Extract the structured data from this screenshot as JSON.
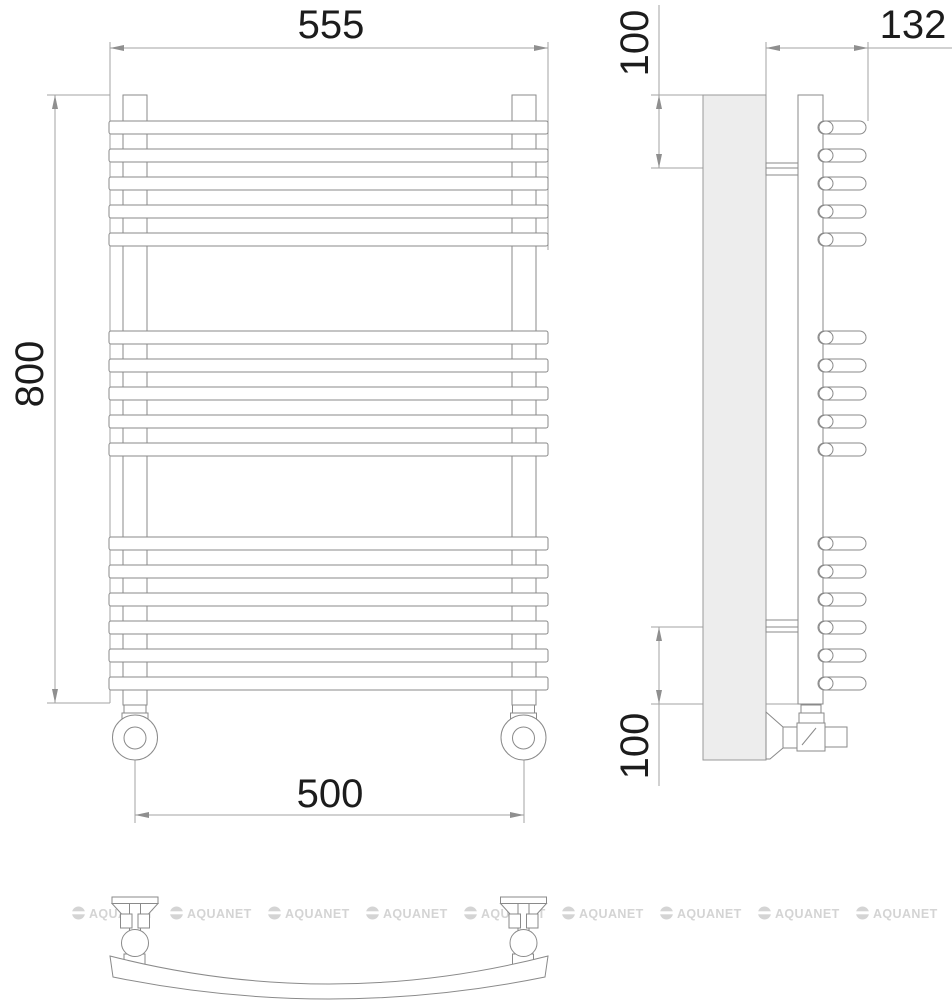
{
  "drawing": {
    "type": "technical-drawing",
    "subject": "curved ladder towel rail with side valves, three orthographic views"
  },
  "dimensions": {
    "overall_width": "555",
    "overall_height": "800",
    "connection_spacing": "500",
    "depth": "132",
    "bracket_offset_top": "100",
    "bracket_offset_bottom": "100"
  },
  "structure": {
    "rung_groups": [
      5,
      5,
      6
    ],
    "rung_tops": [
      121,
      149,
      177,
      205,
      233,
      331,
      359,
      387,
      415,
      443,
      537,
      565,
      593,
      621,
      649,
      677
    ],
    "rung_height": 13,
    "post_centers": [
      135,
      523.5
    ]
  },
  "watermark": {
    "text": "AQUANET",
    "icon": "brand-globe-icon",
    "color": "#d4d4d4",
    "repeat": 9
  },
  "colors": {
    "line": "#8a8a8a",
    "dimension": "#a3a3a3",
    "panel_fill": "#ededed",
    "text": "#1c1c1c"
  }
}
